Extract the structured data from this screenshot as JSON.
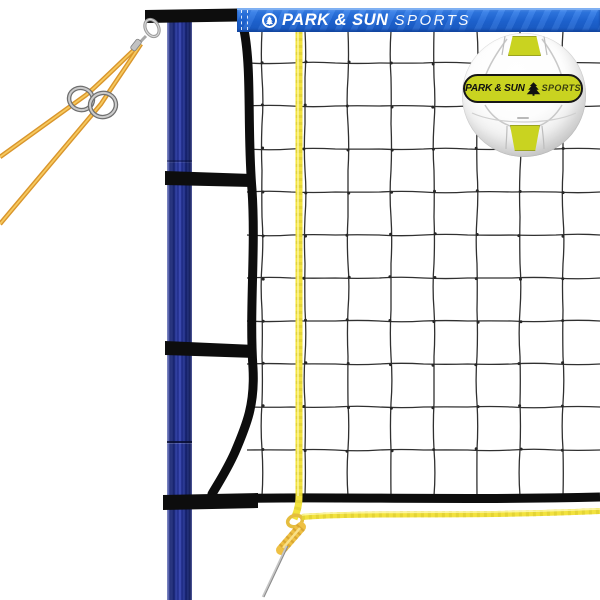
{
  "banner": {
    "brand": "PARK & SUN",
    "suffix": "SPORTS"
  },
  "ball": {
    "brand": "PARK & SUN",
    "suffix": "SPORTS"
  },
  "icons": {
    "banner_logo": "circle-pine-tree-icon",
    "ball_logo": "pine-tree-icon"
  },
  "colors": {
    "banner_blue": "#2268d9",
    "pole_blue": "#1e2f9a",
    "net_black": "#0d0d0d",
    "net_cord_gray": "#303030",
    "court_rope_yellow": "#f2e23e",
    "guy_rope_gold": "#e09c30",
    "ball_panel_chartreuse": "#c9d320",
    "background_white": "#ffffff"
  }
}
